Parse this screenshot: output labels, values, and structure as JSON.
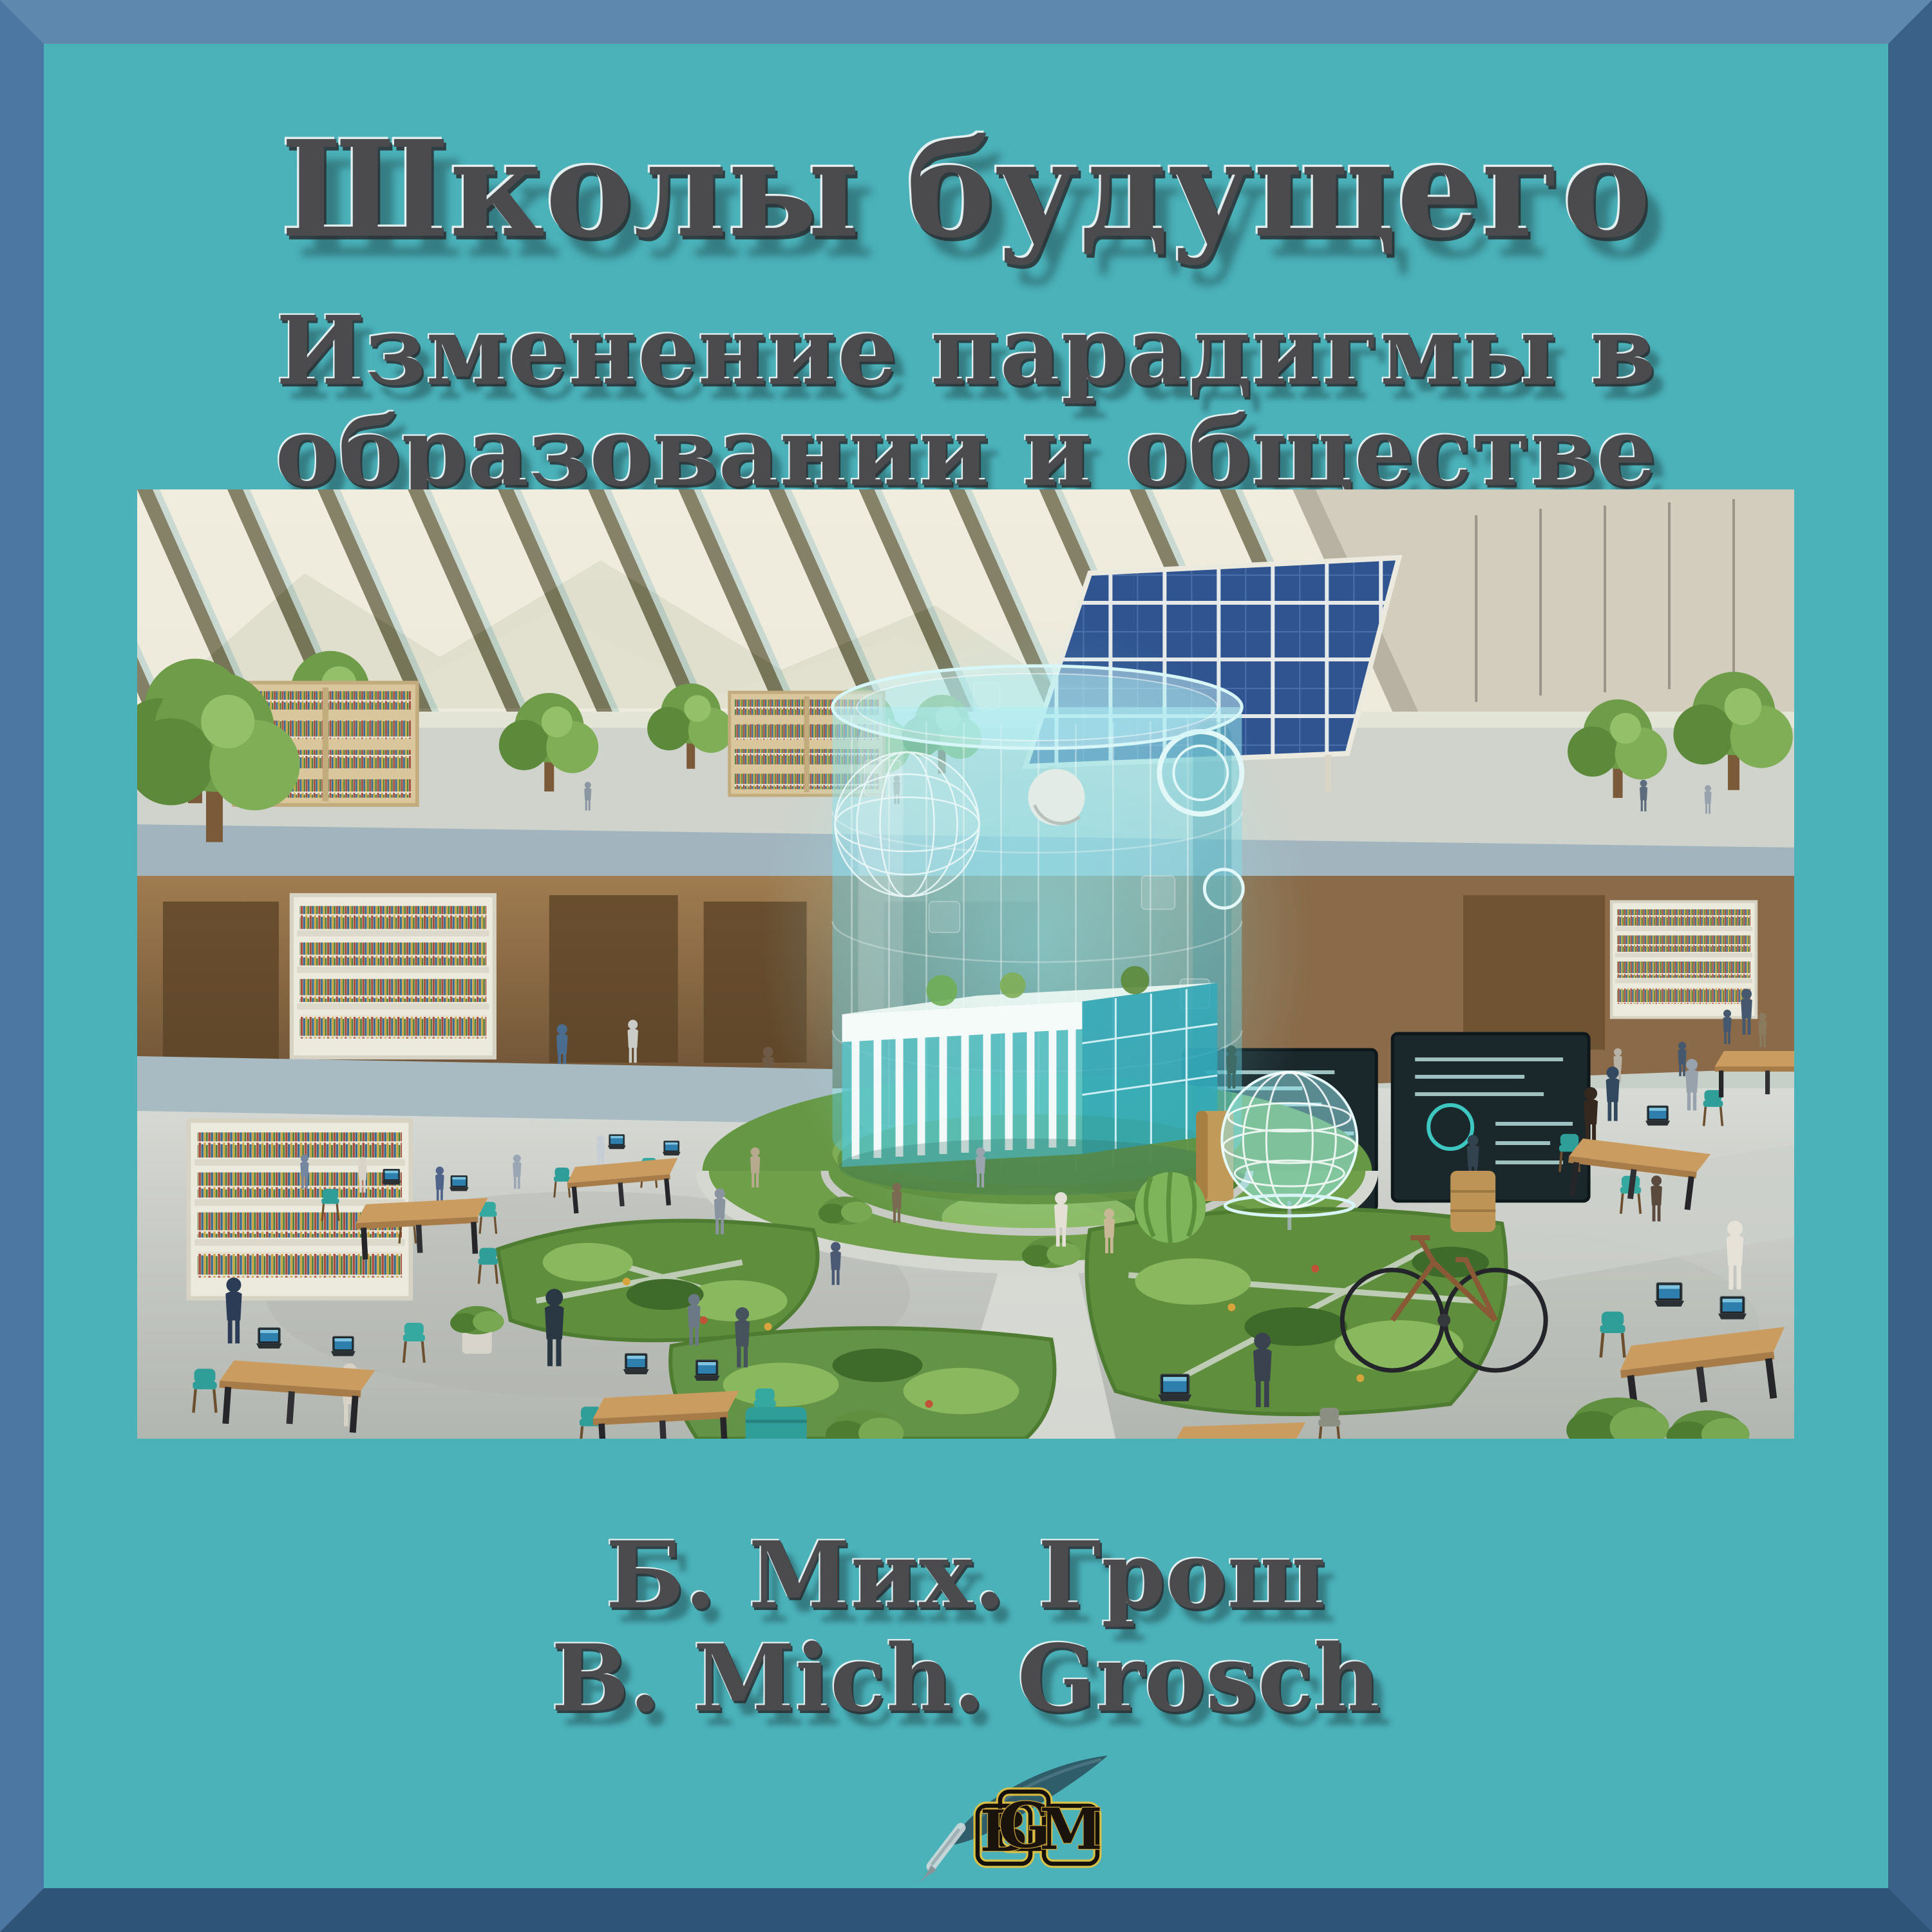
{
  "cover": {
    "title": "Школы будущего",
    "subtitle": [
      "Изменение парадигмы в",
      "образовании и обществе"
    ],
    "authors": [
      "Б. Мих. Грош",
      "B. Mich. Grosch"
    ],
    "publisher_logo": {
      "letters": [
        "B",
        "G",
        "M"
      ]
    },
    "colors": {
      "background": "#4bb2ba",
      "frame_top": "#5e88ae",
      "frame_left": "#4c77a2",
      "frame_right": "#3a6288",
      "frame_bottom": "#2e5578",
      "title_text": "#4b4b4e",
      "logo_gold": "#e7c23c",
      "logo_black": "#15100a",
      "hologram_cyan": "#7fe0ea",
      "solar_blue": "#2f5490",
      "chair_teal": "#2f9e98",
      "table_wood": "#cb9c60"
    }
  }
}
